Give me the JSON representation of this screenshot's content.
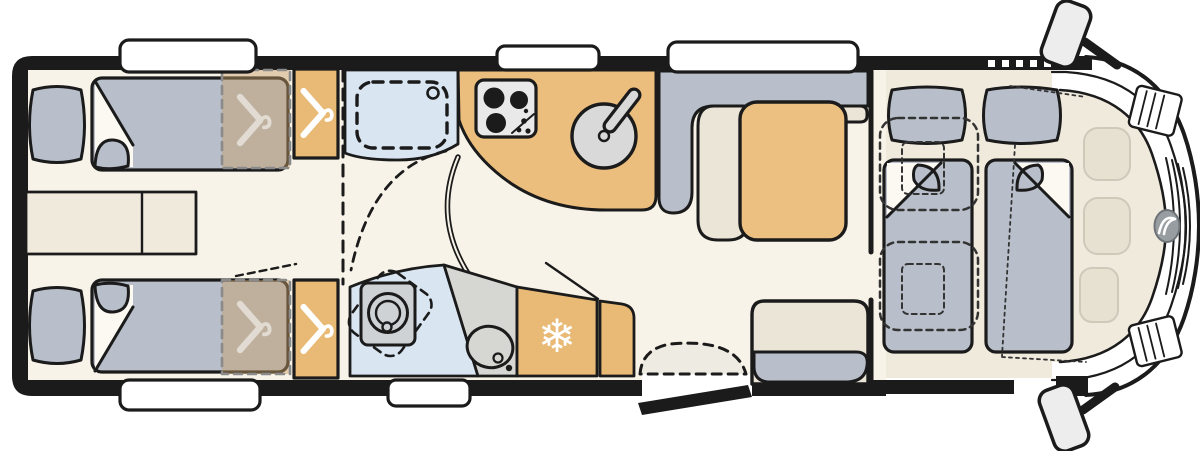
{
  "icons": {
    "snowflake_glyph": "❄",
    "hanger": "hanger-icon",
    "stove": "stove-burners-icon",
    "sink": "round-sink-icon",
    "basin": "oval-basin-icon",
    "toilet": "swivel-toilet-icon",
    "shower_tray": "shower-tray-icon",
    "entry_step": "entry-step-icon",
    "brand_logo": "brand-oval-logo-icon",
    "mirror": "wing-mirror-icon"
  },
  "colors": {
    "wall": "#1b1b1b",
    "floor": "#f8f3e8",
    "cab_floor": "#f0eadd",
    "bedding_gray": "#b8bfca",
    "cushion_cream": "#ebe5d8",
    "wardrobe_tan": "#e8ba76",
    "counter_tan": "#ecbe7e",
    "table_tan": "#ecc080",
    "overlay_tan": "#c69e66",
    "overlay_dash": "#8a8a8a",
    "bath_blue": "#d9e5f1",
    "stove_panel": "#e9e9e9",
    "sink_gray": "#d9d9d9",
    "counter_gray": "#d6d6d2",
    "toilet_gray": "#ced2d5",
    "step_gray": "#edebe2",
    "ghost": "#e7e1d2",
    "ghost_line": "#cfc9ba",
    "logo_gray": "#979da1",
    "mattress_white": "#fcf9f2",
    "white": "#ffffff"
  }
}
